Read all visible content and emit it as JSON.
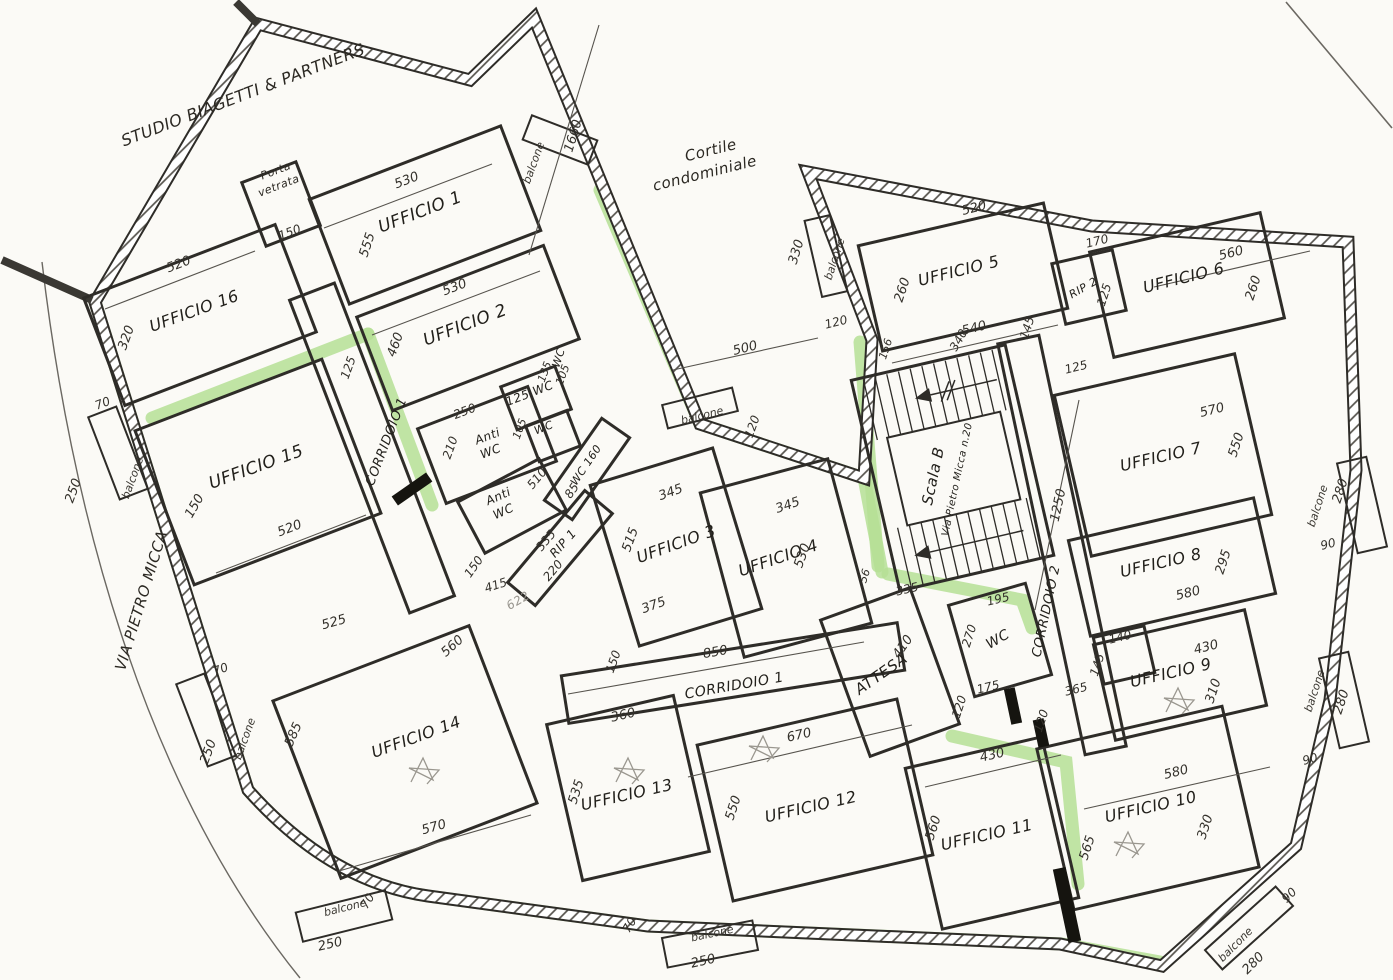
{
  "title": "Planimetria piano uffici - Scala B, Via Pietro Micca n.20",
  "colors": {
    "paper": "#fbfaf6",
    "ink": "#2e2c28",
    "highlight": "#b5df95",
    "pencil": "#98958e"
  },
  "context": {
    "neighbor": "STUDIO BIAGETTI & PARTNERS",
    "courtyard": "Cortile condominiale",
    "street": "VIA PIETRO MICCA",
    "entrance": "Porta vetrata",
    "stairs": "Scala B",
    "stairs_address": "Via Pietro Micca n.20",
    "balcony": "balcone"
  },
  "labels": [
    {
      "id": "ctx-studio",
      "t": "STUDIO BIAGETTI & PARTNERS"
    },
    {
      "id": "ctx-porta-1",
      "t": "Porta"
    },
    {
      "id": "ctx-porta-2",
      "t": "vetrata"
    },
    {
      "id": "ctx-cortile-1",
      "t": "Cortile"
    },
    {
      "id": "ctx-cortile-2",
      "t": "condominiale"
    },
    {
      "id": "ctx-via",
      "t": "VIA PIETRO MICCA"
    },
    {
      "id": "room-u1",
      "t": "UFFICIO 1"
    },
    {
      "id": "room-u2",
      "t": "UFFICIO 2"
    },
    {
      "id": "room-u3",
      "t": "UFFICIO 3"
    },
    {
      "id": "room-u4",
      "t": "UFFICIO 4"
    },
    {
      "id": "room-u5",
      "t": "UFFICIO 5"
    },
    {
      "id": "room-u6",
      "t": "UFFICIO 6"
    },
    {
      "id": "room-u7",
      "t": "UFFICIO 7"
    },
    {
      "id": "room-u8",
      "t": "UFFICIO 8"
    },
    {
      "id": "room-u9",
      "t": "UFFICIO 9"
    },
    {
      "id": "room-u10",
      "t": "UFFICIO 10"
    },
    {
      "id": "room-u11",
      "t": "UFFICIO 11"
    },
    {
      "id": "room-u12",
      "t": "UFFICIO 12"
    },
    {
      "id": "room-u13",
      "t": "UFFICIO 13"
    },
    {
      "id": "room-u14",
      "t": "UFFICIO 14"
    },
    {
      "id": "room-u15",
      "t": "UFFICIO 15"
    },
    {
      "id": "room-u16",
      "t": "UFFICIO 16"
    },
    {
      "id": "room-scala",
      "t": "Scala B"
    },
    {
      "id": "room-scala-sub",
      "t": "Via Pietro Micca n.20"
    },
    {
      "id": "room-attesa",
      "t": "ATTESA"
    },
    {
      "id": "room-wc-centro",
      "t": "WC"
    },
    {
      "id": "room-antiwc1-1",
      "t": "Anti"
    },
    {
      "id": "room-antiwc1-2",
      "t": "WC"
    },
    {
      "id": "room-antiwc2-1",
      "t": "Anti"
    },
    {
      "id": "room-antiwc2-2",
      "t": "WC"
    },
    {
      "id": "room-rip1",
      "t": "RIP 1"
    },
    {
      "id": "room-rip2",
      "t": "RIP 2"
    },
    {
      "id": "room-wc125",
      "t": "125 WC"
    },
    {
      "id": "room-wc-a",
      "t": "WC"
    },
    {
      "id": "room-wc-b",
      "t": "WC"
    },
    {
      "id": "room-wc160",
      "t": "WC 160"
    },
    {
      "id": "corr1-diag",
      "t": "CORRIDOIO 1"
    },
    {
      "id": "corr1-horiz",
      "t": "CORRIDOIO 1"
    },
    {
      "id": "corr2",
      "t": "CORRIDOIO 2"
    },
    {
      "id": "balc-top",
      "t": "balcone"
    },
    {
      "id": "balc-cortile",
      "t": "balcone"
    },
    {
      "id": "balc-330",
      "t": "balcone"
    },
    {
      "id": "balc-left-1",
      "t": "balcone"
    },
    {
      "id": "balc-left-2",
      "t": "balcone"
    },
    {
      "id": "balc-bottom-1",
      "t": "balcone"
    },
    {
      "id": "balc-bottom-2",
      "t": "balcone"
    },
    {
      "id": "balc-right-1",
      "t": "balcone"
    },
    {
      "id": "balc-right-2",
      "t": "balcone"
    },
    {
      "id": "balc-corner",
      "t": "balcone"
    },
    {
      "id": "dim-1660",
      "t": "1660"
    },
    {
      "id": "dim-530-u1",
      "t": "530"
    },
    {
      "id": "dim-555",
      "t": "555"
    },
    {
      "id": "dim-530-u2",
      "t": "530"
    },
    {
      "id": "dim-460",
      "t": "460"
    },
    {
      "id": "dim-150-porta",
      "t": "150"
    },
    {
      "id": "dim-520-u16",
      "t": "520"
    },
    {
      "id": "dim-320",
      "t": "320"
    },
    {
      "id": "dim-70-l1",
      "t": "70"
    },
    {
      "id": "dim-250-l1",
      "t": "250"
    },
    {
      "id": "dim-150-u15",
      "t": "150"
    },
    {
      "id": "dim-520-u15",
      "t": "520"
    },
    {
      "id": "dim-125-corr1",
      "t": "125"
    },
    {
      "id": "dim-500",
      "t": "500"
    },
    {
      "id": "dim-120-balc",
      "t": "120"
    },
    {
      "id": "dim-330-balc",
      "t": "330"
    },
    {
      "id": "dim-120-u5",
      "t": "120"
    },
    {
      "id": "dim-520-u5",
      "t": "520"
    },
    {
      "id": "dim-260-u5",
      "t": "260"
    },
    {
      "id": "dim-540",
      "t": "540"
    },
    {
      "id": "dim-145-scala",
      "t": "145"
    },
    {
      "id": "dim-156",
      "t": "156"
    },
    {
      "id": "dim-125-corr2a",
      "t": "125"
    },
    {
      "id": "dim-170",
      "t": "170"
    },
    {
      "id": "dim-125-rip2",
      "t": "125"
    },
    {
      "id": "dim-560-u6",
      "t": "560"
    },
    {
      "id": "dim-260-u6",
      "t": "260"
    },
    {
      "id": "dim-570-u7",
      "t": "570"
    },
    {
      "id": "dim-550-u7",
      "t": "550"
    },
    {
      "id": "dim-280-r1",
      "t": "280"
    },
    {
      "id": "dim-90-r1",
      "t": "90"
    },
    {
      "id": "dim-580-u8",
      "t": "580"
    },
    {
      "id": "dim-295",
      "t": "295"
    },
    {
      "id": "dim-430-u9",
      "t": "430"
    },
    {
      "id": "dim-310",
      "t": "310"
    },
    {
      "id": "dim-140",
      "t": "140"
    },
    {
      "id": "dim-145-u9",
      "t": "145"
    },
    {
      "id": "dim-365",
      "t": "365"
    },
    {
      "id": "dim-280-r2",
      "t": "280"
    },
    {
      "id": "dim-90-r2",
      "t": "90"
    },
    {
      "id": "dim-580-u10",
      "t": "580"
    },
    {
      "id": "dim-330-u10",
      "t": "330"
    },
    {
      "id": "dim-565",
      "t": "565"
    },
    {
      "id": "dim-90-corner",
      "t": "90"
    },
    {
      "id": "dim-280-corner",
      "t": "280"
    },
    {
      "id": "dim-430-u11",
      "t": "430"
    },
    {
      "id": "dim-560-u11",
      "t": "560"
    },
    {
      "id": "dim-670",
      "t": "670"
    },
    {
      "id": "dim-550-u12",
      "t": "550"
    },
    {
      "id": "dim-360",
      "t": "360"
    },
    {
      "id": "dim-535",
      "t": "535"
    },
    {
      "id": "dim-850",
      "t": "850"
    },
    {
      "id": "dim-150-corr",
      "t": "150"
    },
    {
      "id": "dim-345-u3",
      "t": "345"
    },
    {
      "id": "dim-515",
      "t": "515"
    },
    {
      "id": "dim-375",
      "t": "375"
    },
    {
      "id": "dim-345-u4",
      "t": "345"
    },
    {
      "id": "dim-530-u4",
      "t": "530"
    },
    {
      "id": "dim-410",
      "t": "410"
    },
    {
      "id": "dim-335-wc",
      "t": "335"
    },
    {
      "id": "dim-195",
      "t": "195"
    },
    {
      "id": "dim-270",
      "t": "270"
    },
    {
      "id": "dim-175",
      "t": "175"
    },
    {
      "id": "dim-120-wc1",
      "t": "120"
    },
    {
      "id": "dim-120-wc2",
      "t": "120"
    },
    {
      "id": "dim-56",
      "t": "56"
    },
    {
      "id": "dim-1250",
      "t": "1250"
    },
    {
      "id": "dim-340",
      "t": "340"
    },
    {
      "id": "dim-525",
      "t": "525"
    },
    {
      "id": "dim-560-u14",
      "t": "560"
    },
    {
      "id": "dim-70-l2",
      "t": "70"
    },
    {
      "id": "dim-250-l2",
      "t": "250"
    },
    {
      "id": "dim-585",
      "t": "585"
    },
    {
      "id": "dim-570-u14",
      "t": "570"
    },
    {
      "id": "dim-70-b1",
      "t": "70"
    },
    {
      "id": "dim-250-b1",
      "t": "250"
    },
    {
      "id": "dim-70-b2",
      "t": "70"
    },
    {
      "id": "dim-250-b2",
      "t": "250"
    },
    {
      "id": "dim-150-wedge",
      "t": "150"
    },
    {
      "id": "dim-415",
      "t": "415"
    },
    {
      "id": "dim-510",
      "t": "510"
    },
    {
      "id": "dim-335-rip",
      "t": "335"
    },
    {
      "id": "dim-220",
      "t": "220"
    },
    {
      "id": "dim-85",
      "t": "85"
    },
    {
      "id": "dim-105-a",
      "t": "105"
    },
    {
      "id": "dim-135",
      "t": "135"
    },
    {
      "id": "dim-105-b",
      "t": "105"
    },
    {
      "id": "dim-250-antiwc",
      "t": "250"
    },
    {
      "id": "dim-210",
      "t": "210"
    },
    {
      "id": "pencil-622",
      "t": "622"
    }
  ]
}
